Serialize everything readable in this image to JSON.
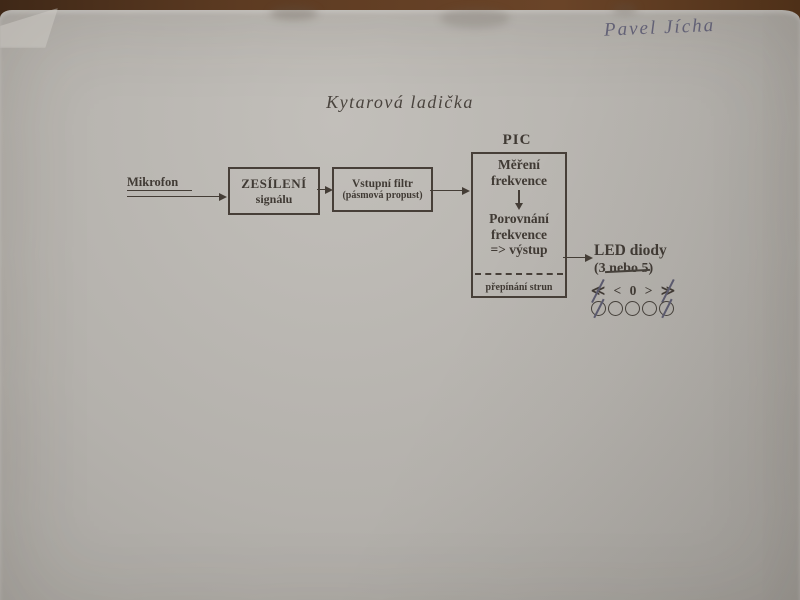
{
  "photo": {
    "handwritten_name": "Pavel Jícha",
    "title": "Kytarová ladička"
  },
  "diagram": {
    "source_label": "Mikrofon",
    "amp_box": {
      "line1": "ZESÍLENÍ",
      "line2": "signálu"
    },
    "filter_box": {
      "line1": "Vstupní filtr",
      "line2": "(pásmová propust)"
    },
    "pic": {
      "label": "PIC",
      "block1_line1": "Měření",
      "block1_line2": "frekvence",
      "block2_line1": "Porovnání",
      "block2_line2": "frekvence",
      "block2_line3": "=> výstup",
      "footer": "přepínání strun"
    },
    "led": {
      "title": "LED diody",
      "count_open": "(3 ",
      "count_struck": "nebo 5",
      "count_close": ")",
      "symbols": [
        "≪",
        "<",
        "0",
        ">",
        "≫"
      ],
      "crossed_symbol_indices": [
        0,
        4
      ],
      "circle_count": 5,
      "crossed_circle_indices": [
        0,
        4
      ]
    }
  },
  "colors": {
    "desk_background": "#5d3b22",
    "paper": "#b3b0ab",
    "print_ink": "#403a34",
    "handwriting_ink": "#56556e",
    "hand_strike": "#5b5a6e"
  }
}
